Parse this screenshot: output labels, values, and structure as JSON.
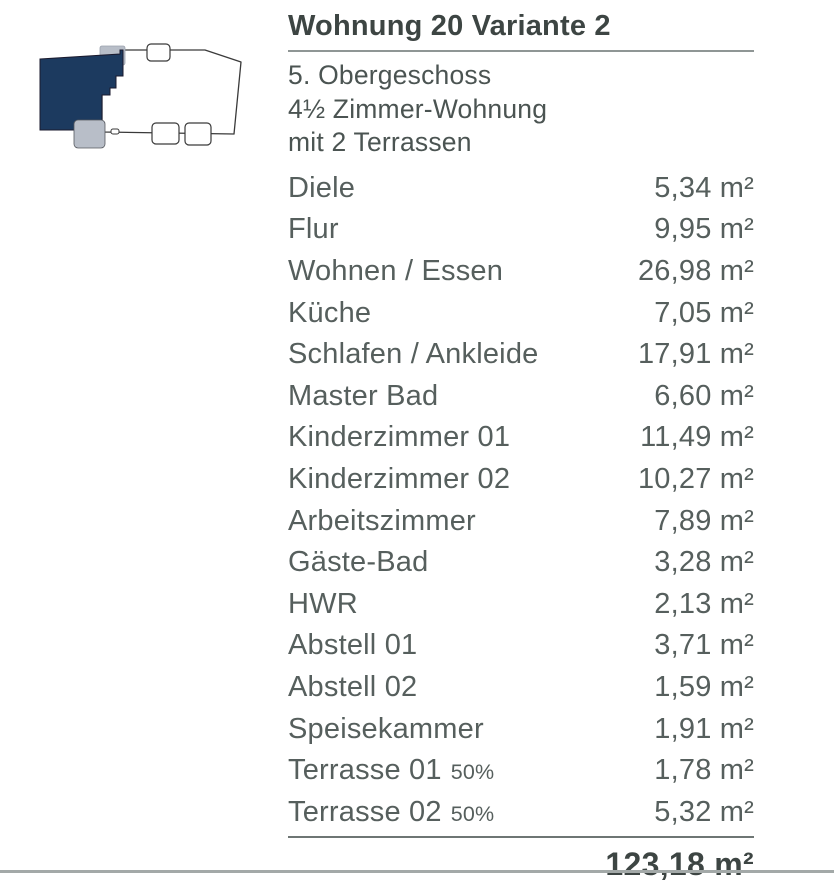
{
  "floorplan": {
    "alt": "building-footprint-with-highlighted-apartment",
    "colors": {
      "highlight": "#1c3a5f",
      "terrace": "#b8bec8",
      "outline": "#3a3a3a",
      "building_fill": "#ffffff"
    }
  },
  "header": {
    "title": "Wohnung 20 Variante 2",
    "subtitle_lines": [
      "5. Obergeschoss",
      "4½ Zimmer-Wohnung",
      "mit 2 Terrassen"
    ]
  },
  "rooms": [
    {
      "name": "Diele",
      "note": "",
      "area": "5,34 m²"
    },
    {
      "name": "Flur",
      "note": "",
      "area": "9,95 m²"
    },
    {
      "name": "Wohnen / Essen",
      "note": "",
      "area": "26,98 m²"
    },
    {
      "name": "Küche",
      "note": "",
      "area": "7,05 m²"
    },
    {
      "name": "Schlafen / Ankleide",
      "note": "",
      "area": "17,91 m²"
    },
    {
      "name": "Master Bad",
      "note": "",
      "area": "6,60 m²"
    },
    {
      "name": "Kinderzimmer 01",
      "note": "",
      "area": "11,49 m²"
    },
    {
      "name": "Kinderzimmer 02",
      "note": "",
      "area": "10,27 m²"
    },
    {
      "name": "Arbeitszimmer",
      "note": "",
      "area": "7,89 m²"
    },
    {
      "name": "Gäste-Bad",
      "note": "",
      "area": "3,28 m²"
    },
    {
      "name": "HWR",
      "note": "",
      "area": "2,13 m²"
    },
    {
      "name": "Abstell 01",
      "note": "",
      "area": "3,71 m²"
    },
    {
      "name": "Abstell 02",
      "note": "",
      "area": "1,59 m²"
    },
    {
      "name": "Speisekammer",
      "note": "",
      "area": "1,91 m²"
    },
    {
      "name": "Terrasse 01",
      "note": "50%",
      "area": "1,78 m²"
    },
    {
      "name": "Terrasse 02",
      "note": "50%",
      "area": "5,32 m²"
    }
  ],
  "total": {
    "area": "123,18 m²"
  }
}
